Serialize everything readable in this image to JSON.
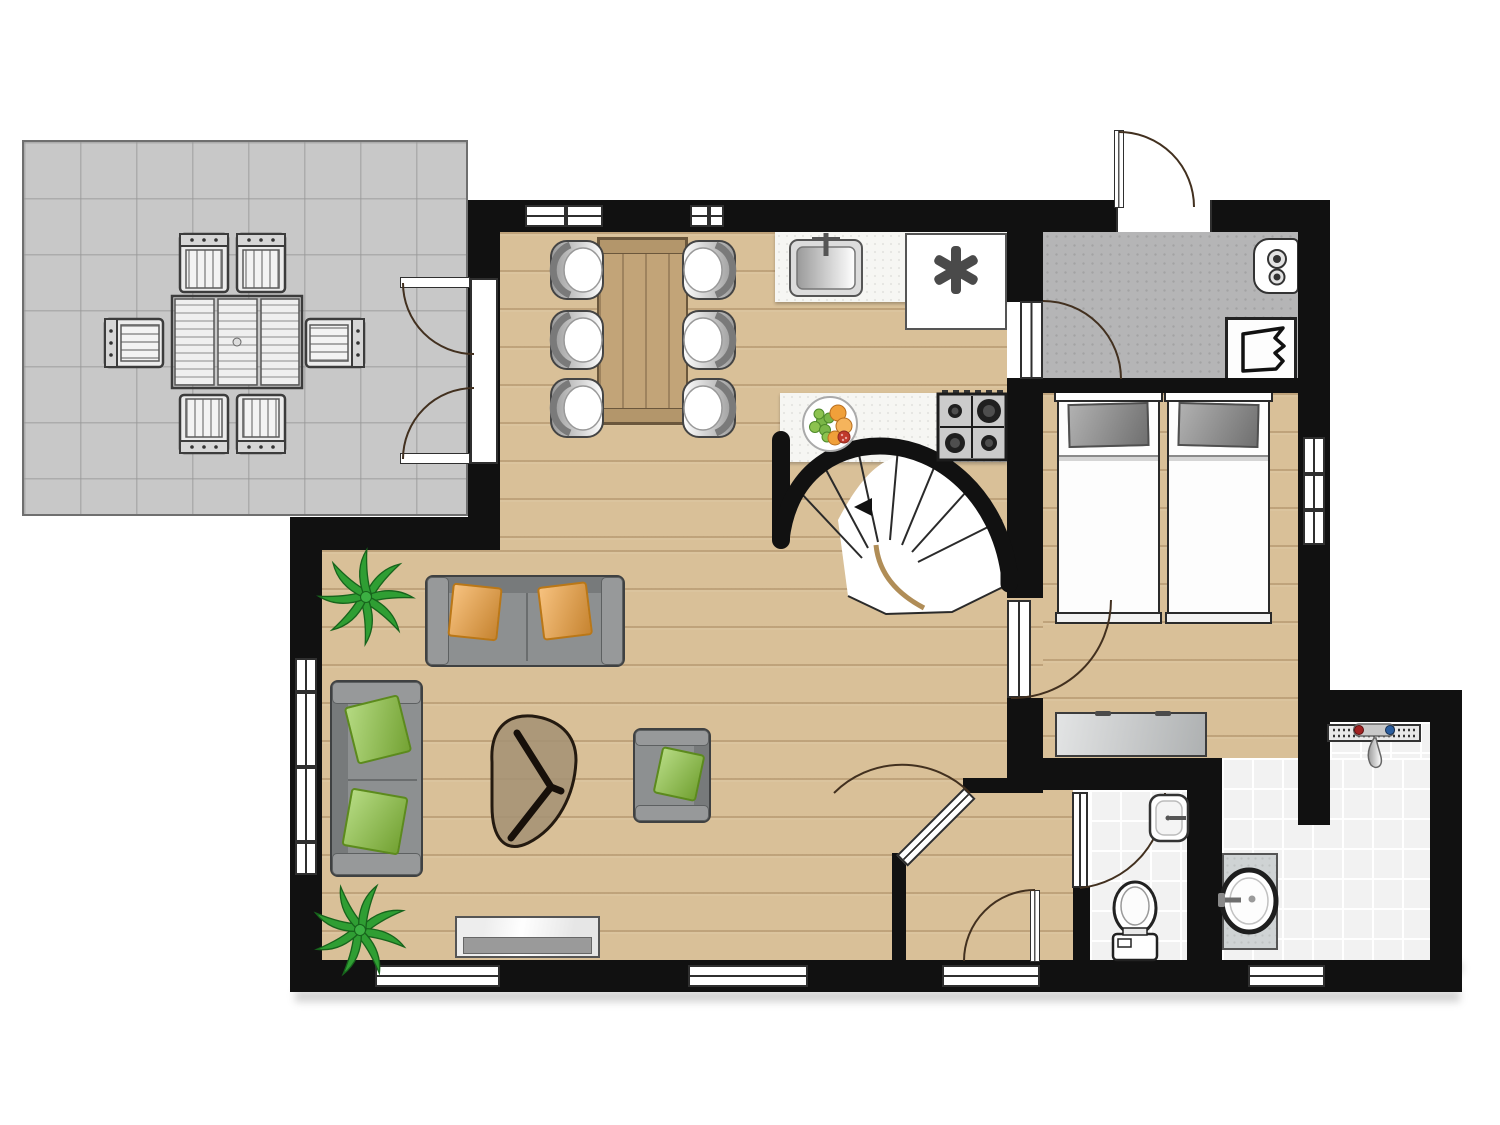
{
  "plan": {
    "type": "architectural-floor-plan",
    "view": "top-down",
    "visible_text": "none",
    "rooms": [
      {
        "id": "terrace",
        "floor": "concrete-tiles",
        "furniture": [
          "outdoor-dining-table",
          "outdoor-chair-top-left",
          "outdoor-chair-top-right",
          "outdoor-chair-bottom-left",
          "outdoor-chair-bottom-right",
          "outdoor-chair-left",
          "outdoor-chair-right"
        ]
      },
      {
        "id": "kitchen-dining",
        "floor": "wood-planks",
        "furniture": [
          "dining-table",
          "dining-chairs-6",
          "kitchen-counter-with-sink",
          "freezer-unit",
          "counter-with-gas-hob",
          "fruit-bowl",
          "winder-staircase"
        ]
      },
      {
        "id": "living-room",
        "floor": "wood-planks",
        "furniture": [
          "two-seat-sofa-top",
          "two-seat-sofa-left",
          "armchair",
          "coffee-table",
          "tv-sideboard",
          "plant-top",
          "plant-bottom"
        ]
      },
      {
        "id": "utility-room",
        "floor": "concrete",
        "furniture": [
          "boiler",
          "washing-machine"
        ]
      },
      {
        "id": "bedroom",
        "floor": "wood-planks",
        "furniture": [
          "single-bed-left",
          "single-bed-right",
          "dresser"
        ]
      },
      {
        "id": "hallway",
        "floor": "wood-planks",
        "furniture": []
      },
      {
        "id": "toilet-room",
        "floor": "white-tile",
        "furniture": [
          "toilet",
          "hand-basin"
        ]
      },
      {
        "id": "bathroom",
        "floor": "white-tile",
        "furniture": [
          "vanity-with-round-basin",
          "walk-in-shower-with-drain"
        ]
      }
    ],
    "openings": {
      "windows": 8,
      "exterior_doors": [
        "french-double-door-to-terrace",
        "utility-entrance-door-top",
        "hall-entrance-door-bottom"
      ],
      "interior_doors": [
        "kitchen-to-utility-door",
        "bedroom-door",
        "toilet-door",
        "living-to-hall-diagonal-door",
        "bedroom-to-bathroom-open-passage"
      ]
    }
  },
  "colors": {
    "wall": "#111111",
    "wood": "#d9c098",
    "terrace": "#c8c8c8",
    "utility": "#b5b5b6",
    "tile": "#f2f2f2",
    "counter": "#f6f6f3",
    "sofaGray": "#8d9091",
    "pillowOrange": "#f2a13b",
    "pillowGreen": "#8dc63f",
    "tableWood": "#c2a478",
    "dresser": "#c6c9ca",
    "bedPillowGray": "#8f8f8f",
    "plantGreen": "#2f9e33",
    "stairEdgeGold": "#b08d57",
    "doorArcBrown": "#42301f"
  }
}
